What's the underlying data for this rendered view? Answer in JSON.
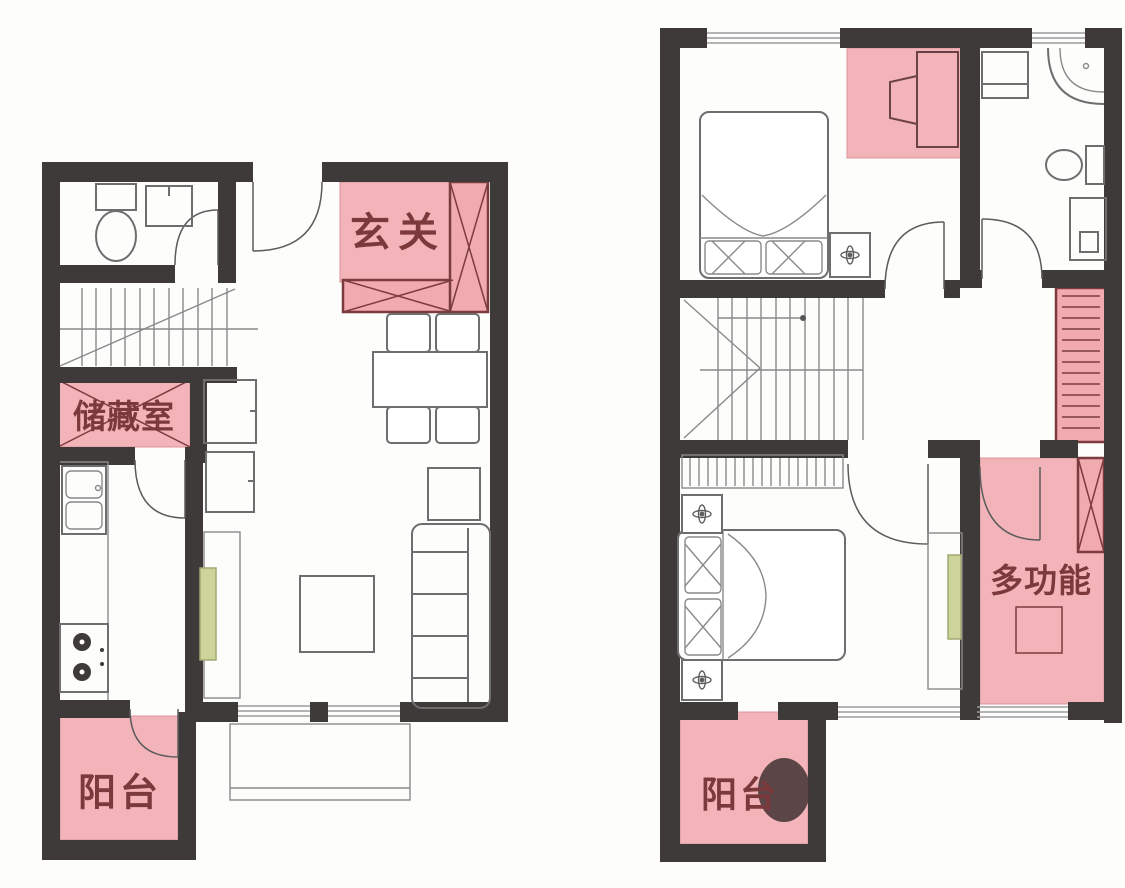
{
  "rooms": {
    "floor1": {
      "entry": "玄关",
      "storage": "储藏室",
      "balcony": "阳台"
    },
    "floor2": {
      "multifunction": "多功能",
      "balcony": "阳台"
    }
  },
  "colors": {
    "wall": "#3e3a39",
    "room_highlight": "#f3b4b9",
    "cabinet_border": "#7c3c3f",
    "label_text": "#7c393c",
    "accent_green": "#ccd49b"
  }
}
